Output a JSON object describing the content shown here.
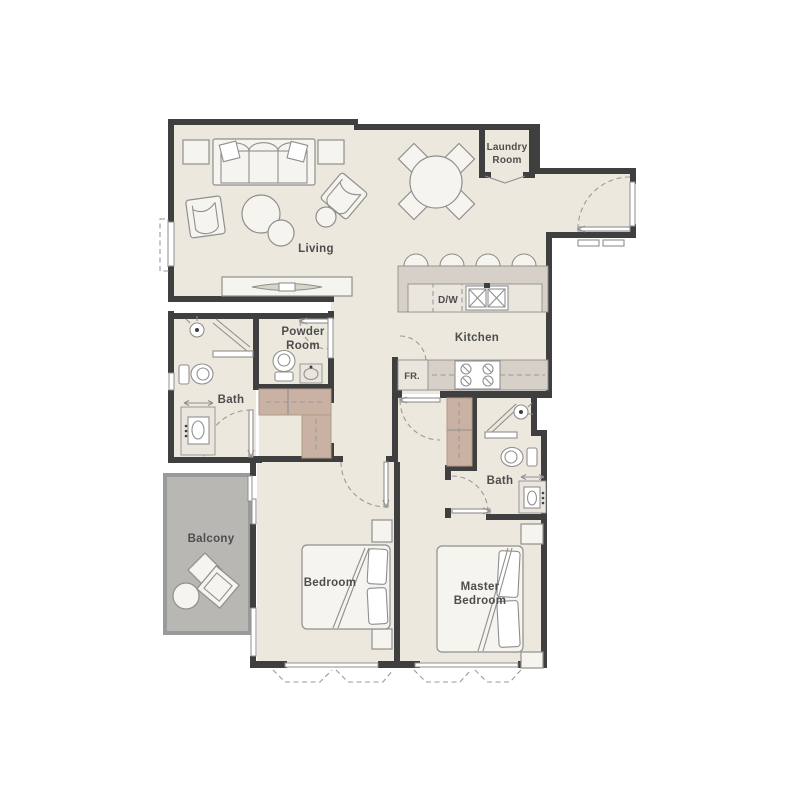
{
  "plan": {
    "title": "Two bedroom apartment floor plan",
    "rooms": {
      "living": {
        "label": "Living"
      },
      "kitchen": {
        "label": "Kitchen"
      },
      "laundry": {
        "line1": "Laundry",
        "line2": "Room"
      },
      "powder": {
        "line1": "Powder",
        "line2": "Room"
      },
      "bath_left": {
        "label": "Bath"
      },
      "bath_right": {
        "label": "Bath"
      },
      "balcony": {
        "label": "Balcony"
      },
      "bedroom": {
        "label": "Bedroom"
      },
      "master": {
        "line1": "Master",
        "line2": "Bedroom"
      }
    },
    "appliances": {
      "dishwasher": {
        "label": "D/W"
      },
      "fridge": {
        "label": "FR."
      }
    },
    "colors": {
      "wall": "#3f3f3f",
      "floor": "#ece8dd",
      "balcony_floor": "#b9b7b4",
      "balcony_wall": "#9a9a9a",
      "counter": "#d7d0c8",
      "counter_light": "#eae6dd",
      "wardrobe": "#c9b2a3",
      "wardrobe_line": "#b29987",
      "furniture_fill": "#f6f4ee",
      "furniture_line": "#8f8f8f",
      "window_line": "#8f8f8f",
      "dash": "#9a9a9a",
      "text": "#4d4d4d"
    }
  }
}
